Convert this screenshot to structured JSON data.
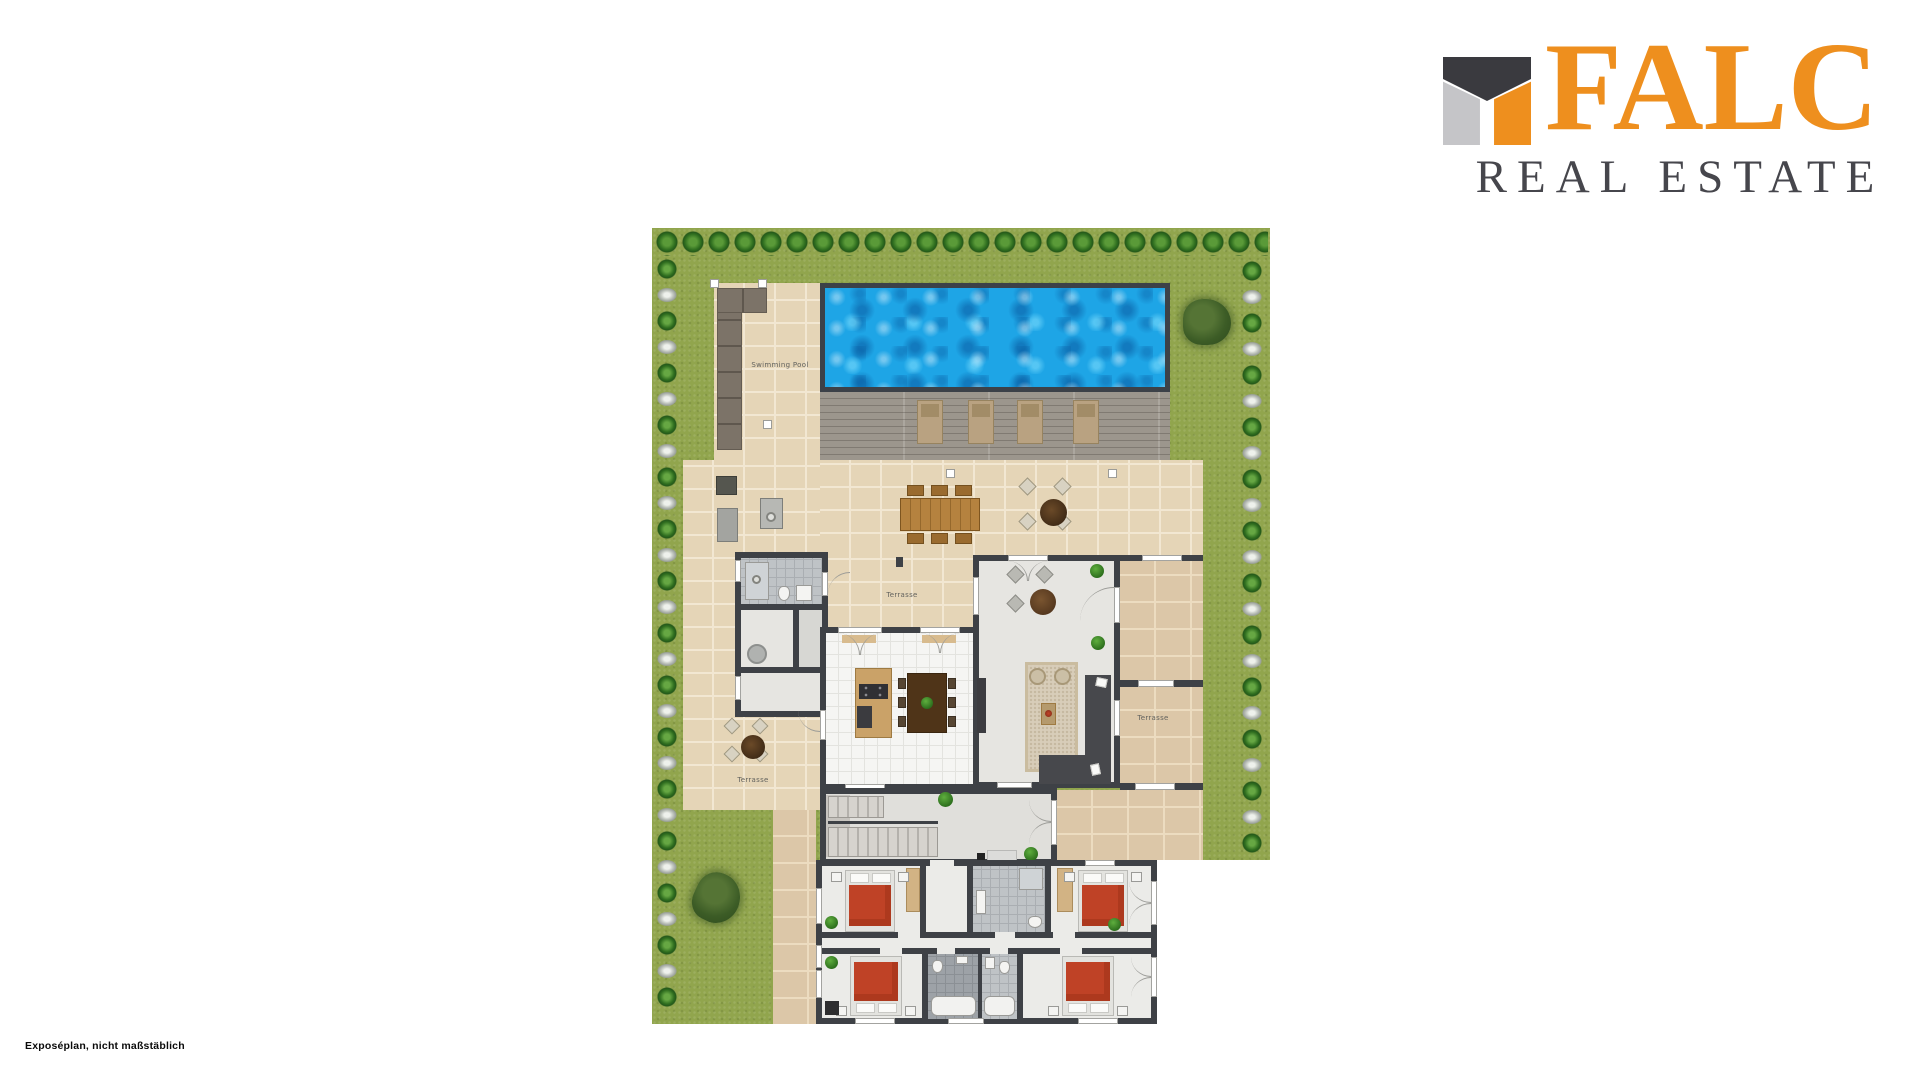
{
  "logo": {
    "brand": "FALC",
    "tagline": "REAL ESTATE",
    "colors": {
      "orange": "#EE8F1E",
      "dark": "#3A3A3F",
      "gray": "#C5C5C8",
      "tagline_text": "#46464C"
    }
  },
  "caption": {
    "text": "Exposéplan, nicht maßstäblich"
  },
  "plan": {
    "labels": {
      "pool": "Swimming Pool",
      "terrace_main": "Terrasse",
      "terrace_right": "Terrasse",
      "terrace_garden": "Terrasse"
    },
    "features": {
      "sun_loungers": 4,
      "bedrooms": 4,
      "bathrooms": 4,
      "terraces": 3
    },
    "colors": {
      "grass": "#91A54D",
      "hedge": "#2F6E1F",
      "pool_water": "#1EA5E6",
      "pool_frame": "#3C4148",
      "deck": "#9C968D",
      "paving": "#E5D5B7",
      "paving_dark": "#DCC7A8",
      "wall": "#3E4146",
      "bed_cover": "#BF4226",
      "wardrobe": "#D2B384",
      "sofa": "#47484C",
      "kitchen_floor": "#F5F5F3"
    }
  }
}
